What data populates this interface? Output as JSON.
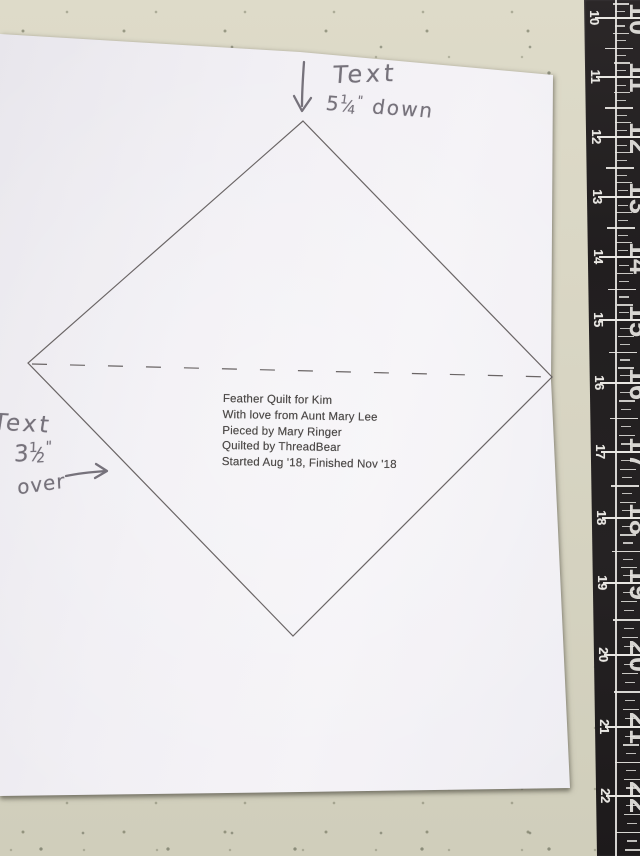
{
  "colors": {
    "countertop": "#d8d5c3",
    "paper": "#f0eef3",
    "ruler_body": "#232021",
    "ruler_marks": "#e9e7e3",
    "ink_hand": "#76727b",
    "ink_print": "#5b5555"
  },
  "quilt_label": {
    "lines": [
      "Feather Quilt for Kim",
      "With love from Aunt Mary Lee",
      "Pieced by Mary Ringer",
      "Quilted by ThreadBear",
      "Started Aug '18, Finished Nov '18"
    ]
  },
  "annotations": {
    "top": {
      "word": "Text",
      "whole": "5",
      "frac_num": "1",
      "frac_den": "4",
      "unit": "\"",
      "direction": "down"
    },
    "left": {
      "word": "Text",
      "whole": "3",
      "frac_num": "1",
      "frac_den": "2",
      "unit": "\"",
      "direction": "over"
    }
  },
  "ruler": {
    "marks": [
      {
        "label": "",
        "y": -41
      },
      {
        "label": "10",
        "y": 18
      },
      {
        "label": "11",
        "y": 77
      },
      {
        "label": "12",
        "y": 137
      },
      {
        "label": "13",
        "y": 197
      },
      {
        "label": "14",
        "y": 257
      },
      {
        "label": "15",
        "y": 320
      },
      {
        "label": "16",
        "y": 383
      },
      {
        "label": "17",
        "y": 452
      },
      {
        "label": "18",
        "y": 518
      },
      {
        "label": "19",
        "y": 583
      },
      {
        "label": "20",
        "y": 655
      },
      {
        "label": "21",
        "y": 727
      },
      {
        "label": "22",
        "y": 796
      },
      {
        "label": "",
        "y": 867
      }
    ]
  }
}
